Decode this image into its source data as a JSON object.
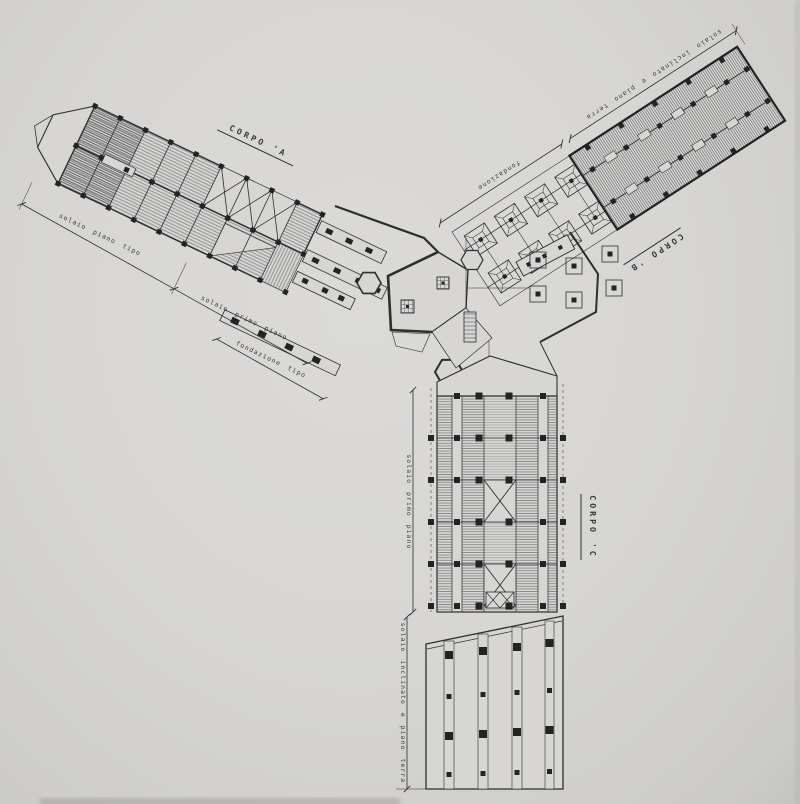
{
  "artwork": {
    "paper_color": "#d7d6d3",
    "ink_color": "#2e2d31"
  },
  "wings": {
    "a": {
      "title": "CORPO 'A",
      "dims": [
        "solaio piano tipo",
        "solaio primo piano",
        "fondazione tipo"
      ]
    },
    "b": {
      "title": "CORPO 'B",
      "dims": [
        "fondazione",
        "solaio inclinato e piano terra"
      ]
    },
    "c": {
      "title": "CORPO 'C",
      "dims": [
        "solaio primo piano",
        "solaio inclinato e piano terra"
      ]
    }
  }
}
